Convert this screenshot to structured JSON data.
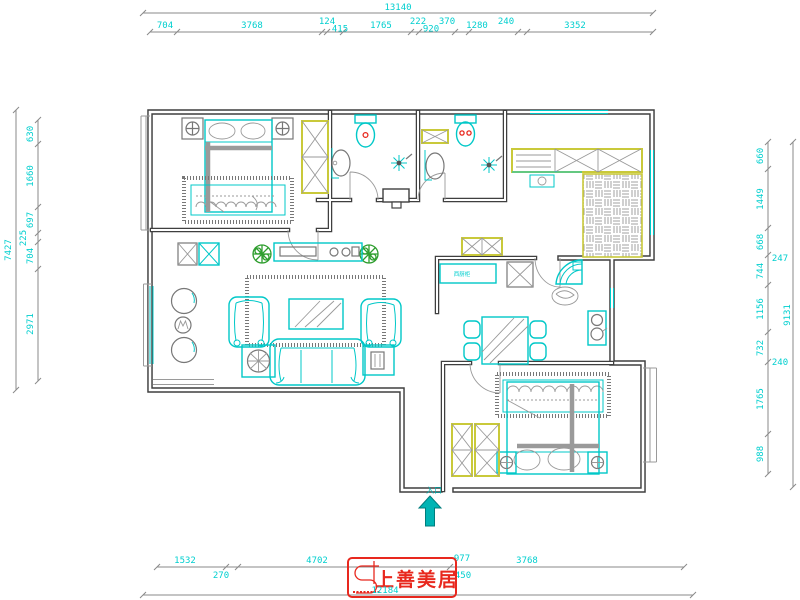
{
  "dims": {
    "top": {
      "total": "13140",
      "chain": [
        "704",
        "3768",
        "124",
        "415",
        "1765",
        "222",
        "920",
        "370",
        "1280",
        "240",
        "3352"
      ]
    },
    "left": {
      "total": "7427",
      "chain": [
        "630",
        "1660",
        "697",
        "225",
        "704",
        "2971"
      ]
    },
    "right": {
      "total": "9131",
      "chain": [
        "660",
        "1449",
        "668",
        "744",
        "1156",
        "732",
        "1765",
        "988"
      ],
      "offset": [
        "247",
        "240"
      ]
    },
    "bottom": {
      "total": "12184",
      "chain": [
        "1532",
        "4702",
        "977",
        "3768"
      ],
      "sub": [
        "270",
        "450"
      ]
    }
  },
  "labels": {
    "entry": "入口",
    "west_cabinet": "西厨柜"
  },
  "logo": {
    "brand": "上善美居"
  },
  "colors": {
    "dimension_cyan": "#00cfcf",
    "furniture_cyan": "#00c8c8",
    "wall_dark": "#3f3f3f",
    "accent_yellow": "#c9c93a",
    "logo_red": "#e8281e",
    "plant_green": "#2f9e2f",
    "arrow_teal": "#00b4b4"
  }
}
